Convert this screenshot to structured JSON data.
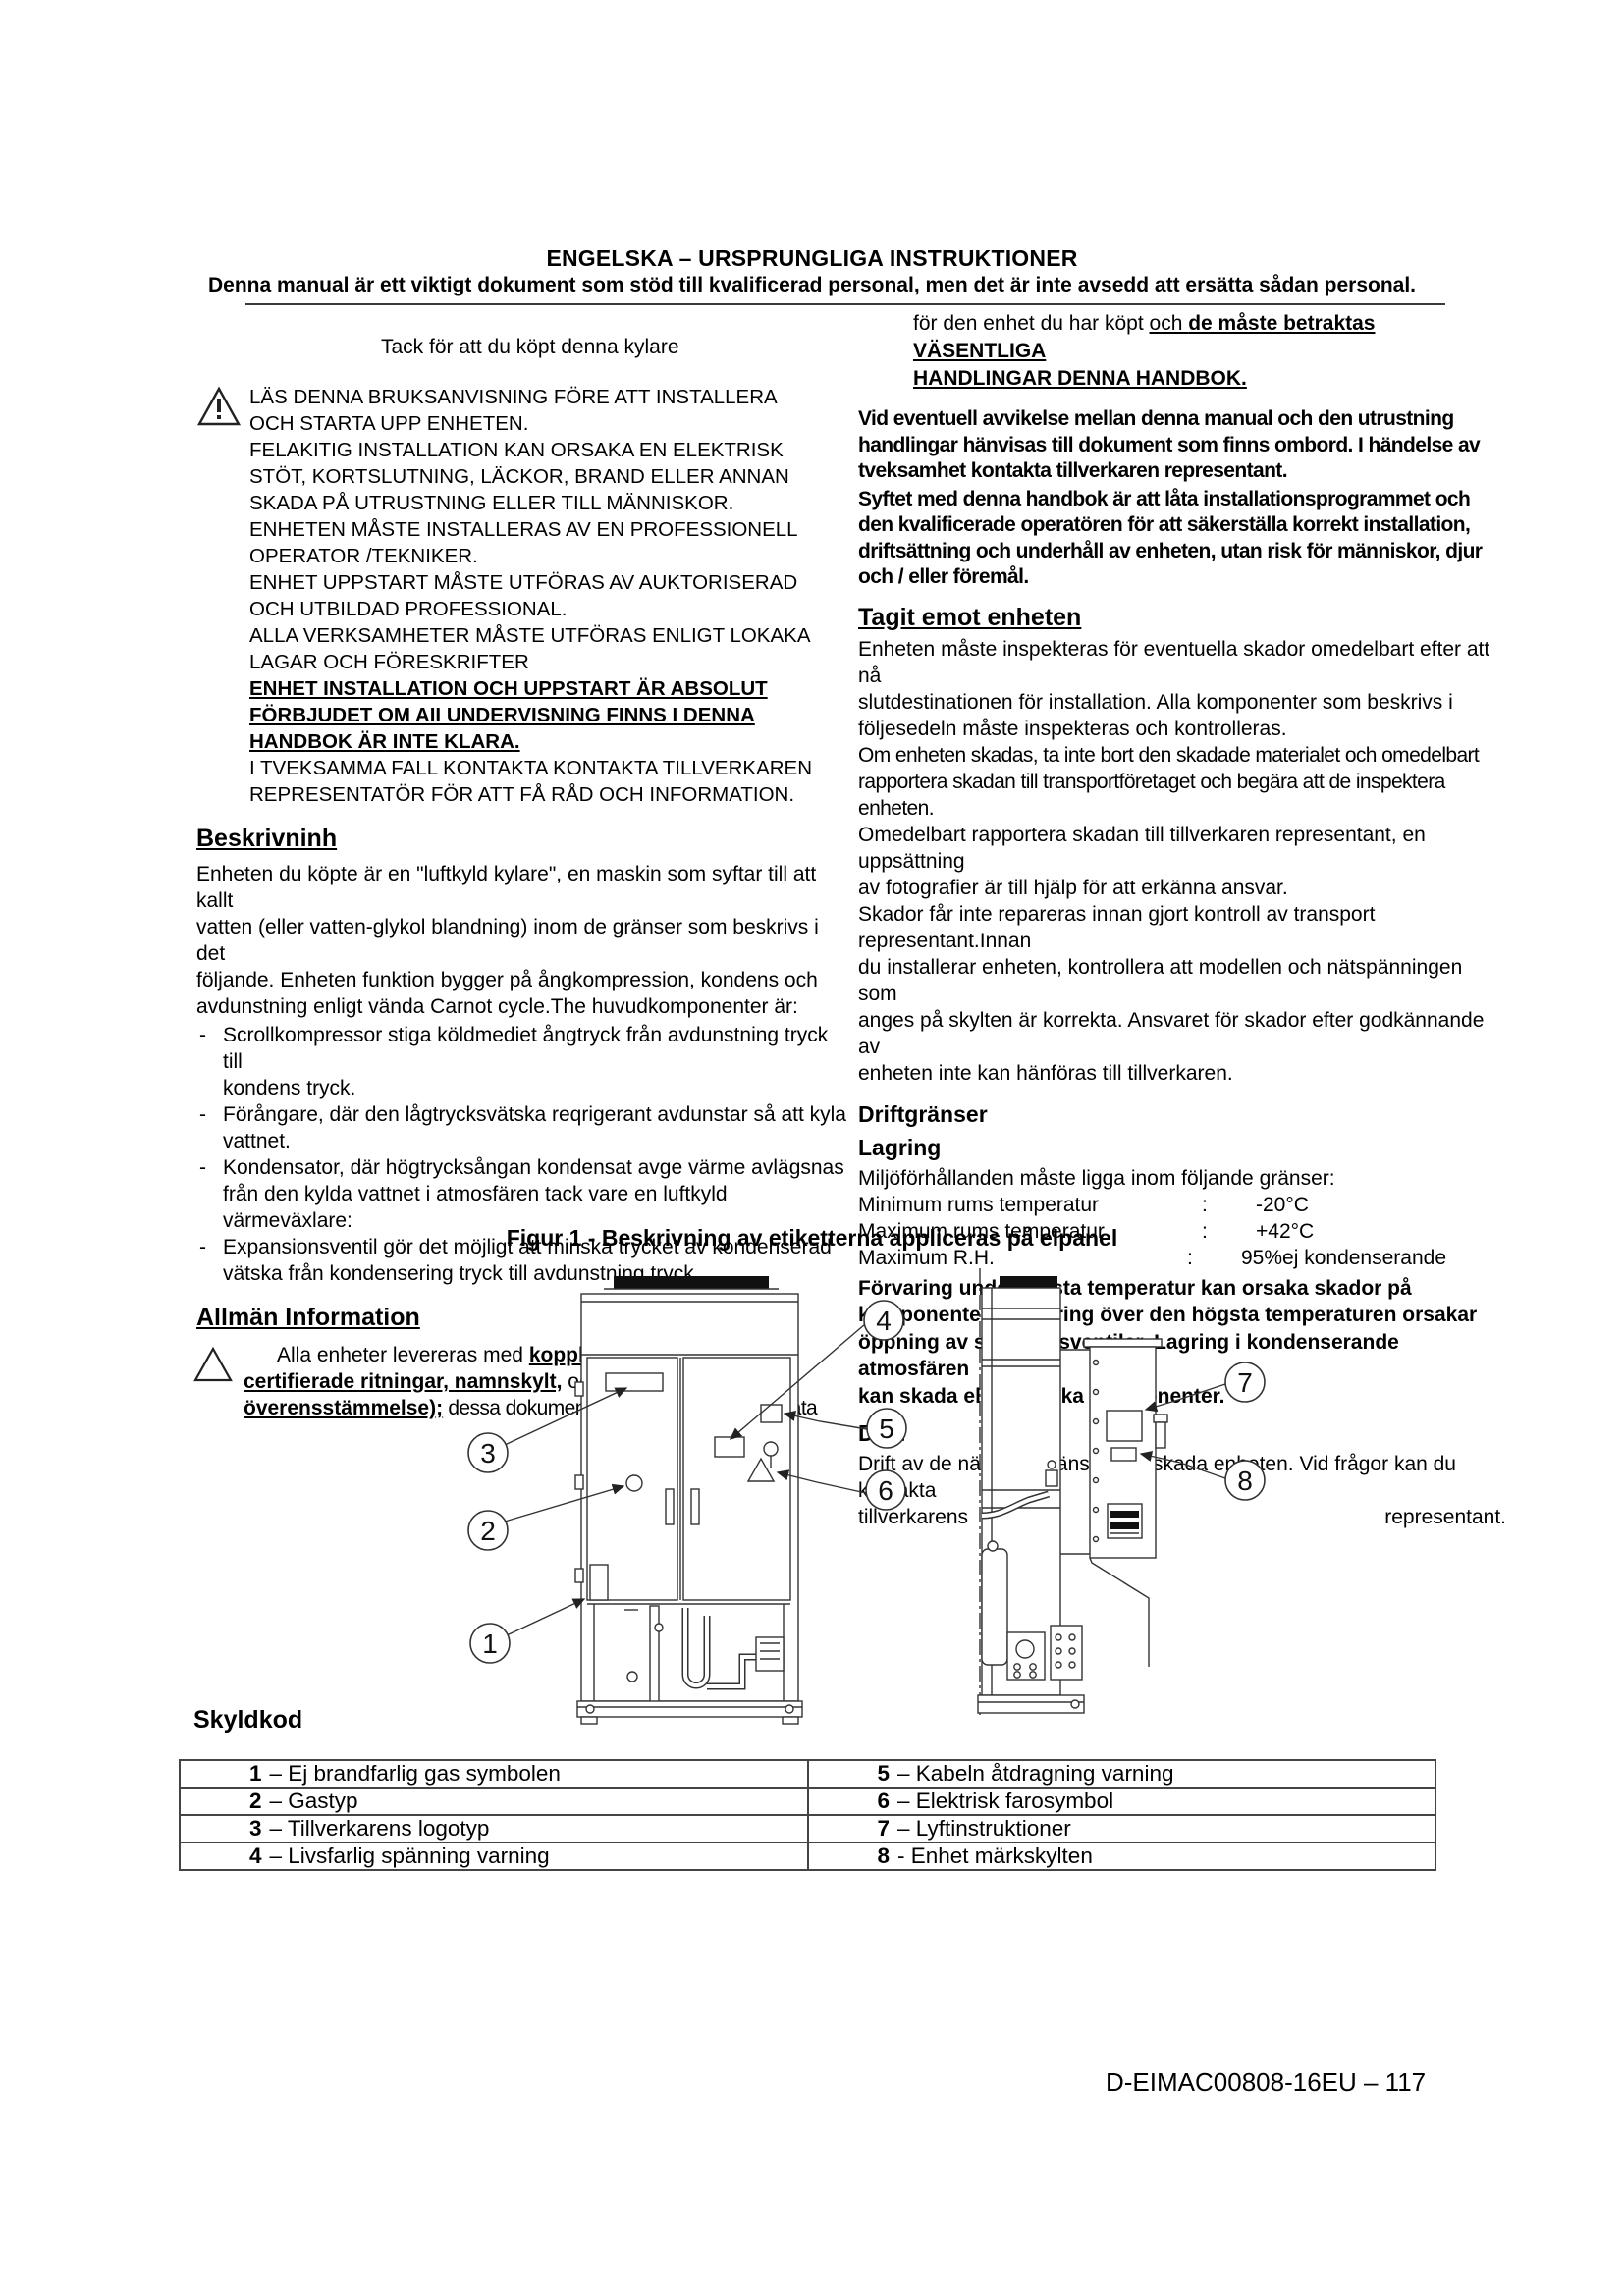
{
  "header": {
    "title": "ENGELSKA – URSPRUNGLIGA INSTRUKTIONER",
    "subtitle": "Denna manual är ett viktigt dokument som stöd till kvalificerad personal, men det är inte avsedd att ersätta sådan personal."
  },
  "left": {
    "thanks": "Tack för att du köpt denna kylare",
    "warning_lines_1": [
      "LÄS DENNA BRUKSANVISNING FÖRE ATT INSTALLERA",
      "OCH STARTA UPP ENHETEN.",
      "FELAKITIG INSTALLATION KAN ORSAKA EN ELEKTRISK",
      "STÖT, KORTSLUTNING, LÄCKOR, BRAND ELLER ANNAN",
      "SKADA PÅ UTRUSTNING ELLER TILL MÄNNISKOR.",
      "ENHETEN MÅSTE INSTALLERAS AV EN PROFESSIONELL",
      "OPERATOR /TEKNIKER.",
      "ENHET UPPSTART MÅSTE UTFÖRAS AV AUKTORISERAD",
      "OCH UTBILDAD PROFESSIONAL.",
      "ALLA VERKSAMHETER MÅSTE UTFÖRAS ENLIGT LOKAKA",
      "LAGAR OCH FÖRESKRIFTER"
    ],
    "warning_lines_bold": [
      "ENHET INSTALLATION OCH UPPSTART ÄR ABSOLUT",
      "FÖRBJUDET OM AII UNDERVISNING FINNS I DENNA",
      "HANDBOK ÄR INTE KLARA."
    ],
    "warning_lines_2": [
      "I TVEKSAMMA FALL KONTAKTA KONTAKTA TILLVERKAREN",
      "REPRESENTATÖR FÖR ATT FÅ RÅD OCH INFORMATION."
    ],
    "desc_heading": "Beskrivninh",
    "desc_lines": [
      "Enheten du köpte är en \"luftkyld kylare\", en maskin som syftar till att kallt",
      "vatten (eller vatten-glykol blandning) inom de gränser som beskrivs i det",
      "följande. Enheten funktion bygger på ångkompression, kondens och",
      "avdunstning enligt vända Carnot cycle.The huvudkomponenter är:"
    ],
    "bullets": [
      [
        "Scrollkompressor stiga köldmediet ångtryck från avdunstning tryck till",
        "kondens tryck."
      ],
      [
        "Förångare, där den lågtrycksvätska reqrigerant avdunstar så att kyla",
        "vattnet."
      ],
      [
        "Kondensator, där högtrycksångan kondensat avge värme avlägsnas",
        "från den kylda vattnet i atmosfären tack vare en luftkyld värmeväxlare:"
      ],
      [
        "Expansionsventil gör det möjligt att minska trycket av kondenserad",
        "vätska från kondensering tryck till avdunstning tryck."
      ]
    ],
    "bullet_dash": "-",
    "info_heading": "Allmän Information",
    "info_seg1": "Alla enheter levereras med ",
    "info_seg2": "kopplingsscheman, certifierade ritningar, namnskylt,",
    "info_seg3": " och ",
    "info_seg4": "DOC (försäkran om överensstämmelse);",
    "info_seg5": " dessa dokument framgår alla tekniska data"
  },
  "right": {
    "p1_l1a": "för den enhet du har köpt ",
    "p1_l1b": "och ",
    "p1_l1c": "de måste betraktas VÄSENTLIGA",
    "p1_l2": "HANDLINGAR DENNA HANDBOK.",
    "p2_lines": [
      "Vid eventuell avvikelse mellan denna manual och den utrustning",
      "handlingar hänvisas till dokument som finns ombord. I händelse av",
      "tveksamhet kontakta tillverkaren representant."
    ],
    "p3_lines": [
      "Syftet med denna handbok är att låta installationsprogrammet och",
      "den kvalificerade operatören för att säkerställa korrekt installation,",
      "driftsättning och underhåll av enheten, utan risk för människor, djur",
      "och / eller föremål."
    ],
    "receive_heading": "Tagit emot enheten",
    "p4_lines": [
      "Enheten måste inspekteras för eventuella skador omedelbart efter att nå",
      "slutdestinationen för installation. Alla komponenter som beskrivs i",
      "följesedeln måste inspekteras och kontrolleras."
    ],
    "p5_lines": [
      "Om enheten skadas, ta inte bort den skadade materialet och omedelbart",
      "rapportera skadan till transportföretaget och begära att de inspektera",
      "enheten."
    ],
    "p6_lines": [
      "Omedelbart rapportera skadan till tillverkaren representant, en uppsättning",
      "av fotografier är till hjälp för att erkänna ansvar.",
      "Skador får inte repareras innan gjort kontroll av transport representant.Innan",
      "du installerar enheten, kontrollera att modellen och nätspänningen som",
      "anges på skylten är korrekta. Ansvaret för skador efter godkännande av",
      "enheten inte kan hänföras till tillverkaren."
    ],
    "limits_heading": "Driftgränser",
    "storage_heading": "Lagring",
    "storage_intro": "Miljöförhållanden måste ligga inom följande gränser:",
    "storage_rows": [
      {
        "label": "Minimum rums temperatur",
        "colon": ":",
        "value": "-20°C"
      },
      {
        "label": "Maximum rums temperatur",
        "colon": ":",
        "value": "+42°C"
      },
      {
        "label": "Maximum R.H.",
        "colon": ":",
        "value": "95%ej kondenserande"
      }
    ],
    "storage_warning_lines": [
      "Förvaring under lägsta temperatur kan orsaka skador på",
      "komponenter. Förvaring över den högsta temperaturen orsakar",
      "öppning av säkerhetsventiler. Lagring i kondenserande atmosfären",
      "kan skada elektroniska komponenter."
    ],
    "operation_heading": "Drift",
    "operation_line1": "Drift av de nämnda gränser kan skada enheten. Vid frågor kan du kontakta",
    "operation_left": "tillverkarens",
    "operation_right": "representant."
  },
  "figure": {
    "caption": "Figur 1 - Beskrivning av etiketterna appliceras på elpanel",
    "callouts": [
      "1",
      "2",
      "3",
      "4",
      "5",
      "6",
      "7",
      "8"
    ]
  },
  "legend": {
    "heading": "Skyldkod",
    "rows": [
      {
        "l_num": "1",
        "l_label": "– Ej brandfarlig gas symbolen",
        "r_num": "5",
        "r_label": "– Kabeln åtdragning varning"
      },
      {
        "l_num": "2",
        "l_label": "– Gastyp",
        "r_num": "6",
        "r_label": "– Elektrisk farosymbol"
      },
      {
        "l_num": "3",
        "l_label": "– Tillverkarens logotyp",
        "r_num": "7",
        "r_label": "– Lyftinstruktioner"
      },
      {
        "l_num": "4",
        "l_label": "– Livsfarlig spänning varning",
        "r_num": "8",
        "r_label": "- Enhet märkskylten"
      }
    ]
  },
  "footer": {
    "doc_code": "D-EIMAC00808-16EU – 117"
  }
}
